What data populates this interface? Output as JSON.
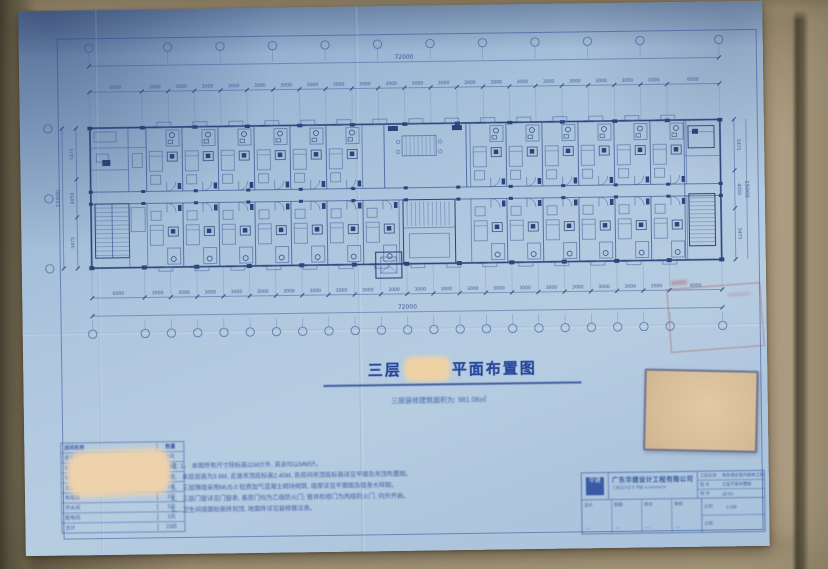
{
  "scene": {
    "description": "photo of a blue-paper floor plan drawing lying on a tan tiled floor"
  },
  "colors": {
    "paper": "#a9c2da",
    "ink": "#34549c",
    "ink_dark": "#1e3a78",
    "floor": "#b3a287",
    "redaction": "#eed2a6",
    "stamp_red": "#b04a50"
  },
  "drawing": {
    "title_prefix": "三层",
    "title_suffix": "平面布置图",
    "subtitle": "三层装修建筑面积为: 981.08㎡"
  },
  "dimensions": {
    "top_total": "72000",
    "bottom_total": "72000",
    "top_row": [
      "6000",
      "3000",
      "3000",
      "3000",
      "3000",
      "3000",
      "3000",
      "3000",
      "3000",
      "3000",
      "3000",
      "3000",
      "3000",
      "3000",
      "3000",
      "3000",
      "3000",
      "3000",
      "3000",
      "3000",
      "3000",
      "6000"
    ],
    "bottom_row": [
      "6000",
      "3000",
      "3000",
      "3000",
      "3000",
      "3000",
      "3000",
      "3000",
      "3000",
      "3000",
      "3000",
      "3000",
      "3000",
      "3000",
      "3000",
      "3000",
      "3000",
      "3000",
      "3000",
      "3000",
      "3000",
      "6000"
    ],
    "left_total": "15000",
    "left_col": [
      "5475",
      "4050",
      "5475"
    ],
    "right_total": "15000",
    "right_col": [
      "5475",
      "4050",
      "5475"
    ]
  },
  "notes": {
    "label": "注:",
    "items": [
      "1、 本图所有尺寸除标高以M计外, 其余均以MM计。",
      "2、 本层层高为3.6M, 走道吊顶底标高2.40M, 各房间吊顶底标高详见平面及吊顶布置图。",
      "3、 三层隔墙采用MU5.0 轻质加气混凝土砌块砌筑, 墙厚详见平面图及墙身大样图。",
      "4、 三层门窗详见门窗表, 客房门均为乙级防火门; 管井检修门为丙级防火门, 向外开启。",
      "5、 卫生间墙面贴瓷砖到顶, 地面砖详见装修做法表。"
    ]
  },
  "room_table": {
    "header": [
      "房间名称",
      "数量"
    ],
    "rows": [
      [
        "豪华套房",
        "1间"
      ],
      [
        "标准双床房",
        "12间"
      ],
      [
        "标准大床房",
        "6间"
      ],
      [
        "无障碍客房",
        "1间"
      ],
      [
        "布草间",
        "1间"
      ],
      [
        "开水间",
        "1间"
      ],
      [
        "配电间",
        "1间"
      ],
      [
        "合计",
        "23间"
      ]
    ]
  },
  "title_block": {
    "logo_text": "华建",
    "company": "广东华建设计工程有限公司",
    "cert": "工程设计证书 甲级 A144005678",
    "rows": [
      {
        "label": "工程名称",
        "value": "商务酒店室内装修工程"
      },
      {
        "label": "图  名",
        "value": "三层平面布置图"
      },
      {
        "label": "图  号",
        "value": "JZ-03"
      }
    ],
    "signs": [
      "设计",
      "制图",
      "校对",
      "审核"
    ],
    "scale_label": "比例",
    "scale_value": "1:100",
    "date_label": "日期",
    "date_value": ""
  }
}
